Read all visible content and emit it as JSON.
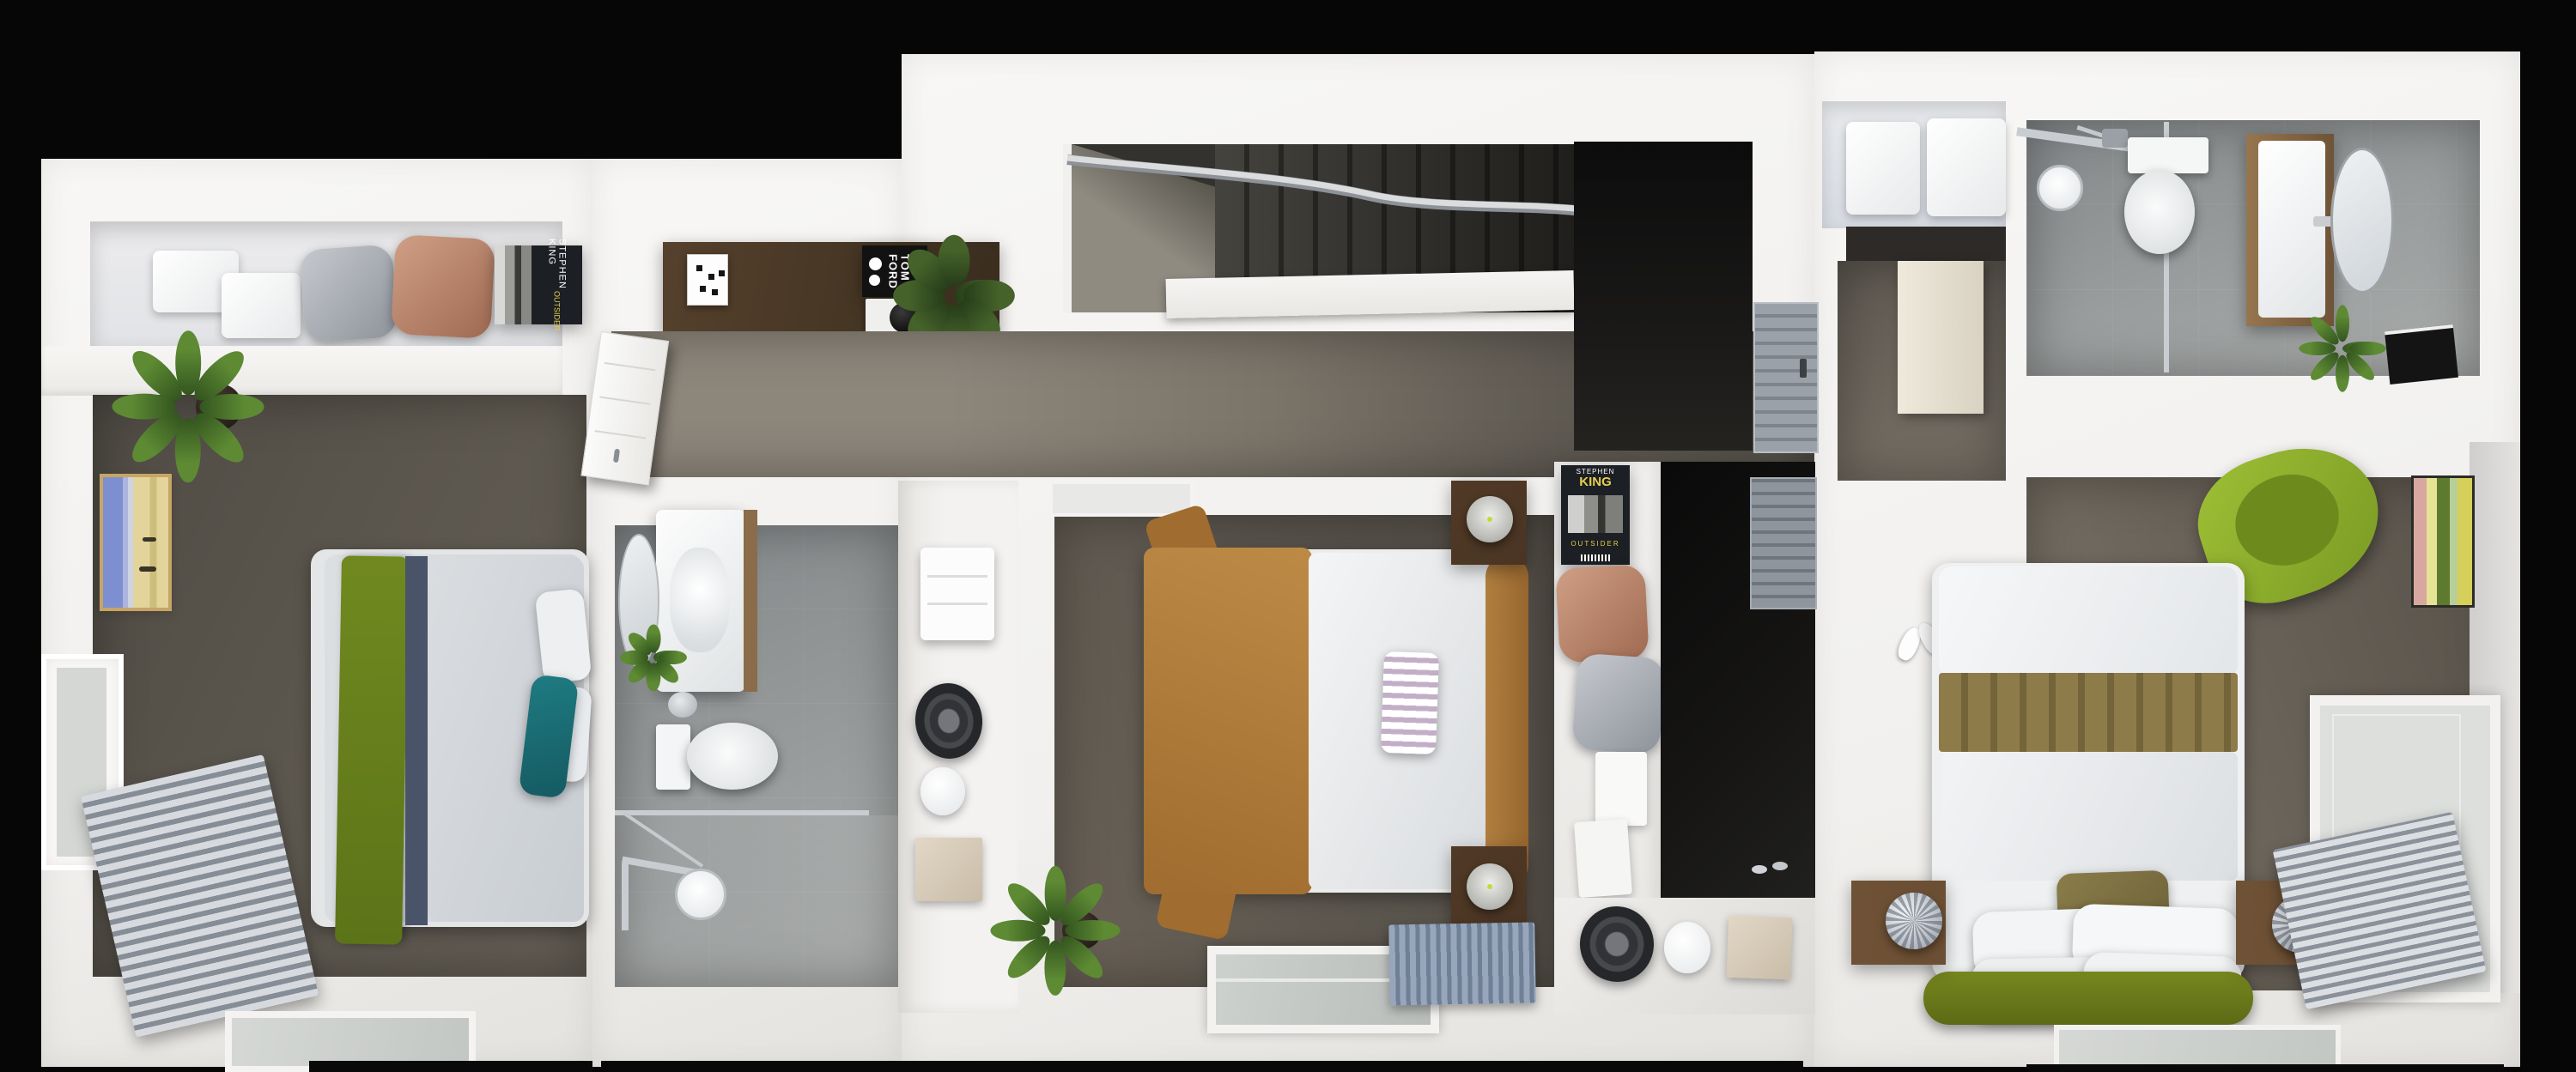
{
  "title": "3D floor plan render - upper storey with three bedrooms and two bathrooms",
  "theme": {
    "bg": "#060606",
    "wall": "#f1f0ee",
    "wallHi": "#f8f7f5",
    "wallLo": "#e4e2de",
    "nicheShade": "#e2e3e6",
    "carpetLeft1": "#4f4b44",
    "carpetLeft2": "#635d54",
    "carpetHall1": "#8d867b",
    "carpetHall2": "#514d46",
    "carpetCenter1": "#514c45",
    "carpetCenter2": "#675f55",
    "carpetRight1": "#575149",
    "carpetRight2": "#7d756a",
    "stair1": "#45433e",
    "stair2": "#2b2a26",
    "voidBlack": "#0c0c0c",
    "tile1": "#84888a",
    "tile2": "#a9acab",
    "wood1": "#55412c",
    "wood2": "#3a2d1e",
    "woodVanity": "#8a6b4a",
    "nightstandC": "#4a3423",
    "nightstandR": "#6b4e33",
    "greenThrow1": "#70891f",
    "greenThrow2": "#5c7418",
    "navyStrip": "#4a5468",
    "teal1": "#1f7b82",
    "teal2": "#155a62",
    "camel1": "#bd8a46",
    "camel2": "#a06c2f",
    "headboardCamel": "#b07f3f",
    "oliveBand1": "#8d7c4a",
    "oliveBand2": "#74643a",
    "olivePillow1": "#8a7d4a",
    "olivePillow2": "#6d6238",
    "bedGreen1": "#77871f",
    "bedGreen2": "#5c6a15",
    "lime1": "#9ebf35",
    "lime2": "#7a9a24",
    "limeSeat": "#6d8a1d",
    "copper1": "#cf9f85",
    "copper2": "#a06a52",
    "silver1": "#c6c9ce",
    "silver2": "#8e939b",
    "blueRug1": "#97a6ba",
    "blueRug2": "#6f7f96",
    "bluePillow": "#5f7596",
    "glass": "#d4d7d3",
    "chrome": "#c9cdd1",
    "chromeDark": "#868d96",
    "lampDot": "#c7d83c",
    "beigeBox1": "#e2d7c5",
    "beigeBox2": "#c9bda9",
    "creamDoor1": "#efe9dc",
    "creamDoor2": "#d9d2c2",
    "bookDark": "#1c1f24",
    "bookYellow": "#e3cf4e",
    "artBlue": "#7d8fd0",
    "artSand": "#e2d49a",
    "artGold": "#c7a566",
    "artGreen": "#5d7a2e",
    "artPink": "#d8a8a0",
    "artYellow": "#d6cf5a",
    "darkStrip": "#090909"
  },
  "books": {
    "outsider_shelf_left": {
      "author": "STEPHEN KING",
      "title": "OUTSIDER"
    },
    "outsider_closet": {
      "author_line1": "STEPHEN",
      "author_line2": "KING",
      "title": "OUTSIDER"
    },
    "tom_ford": {
      "line1": "TOM",
      "line2": "FORD"
    }
  }
}
